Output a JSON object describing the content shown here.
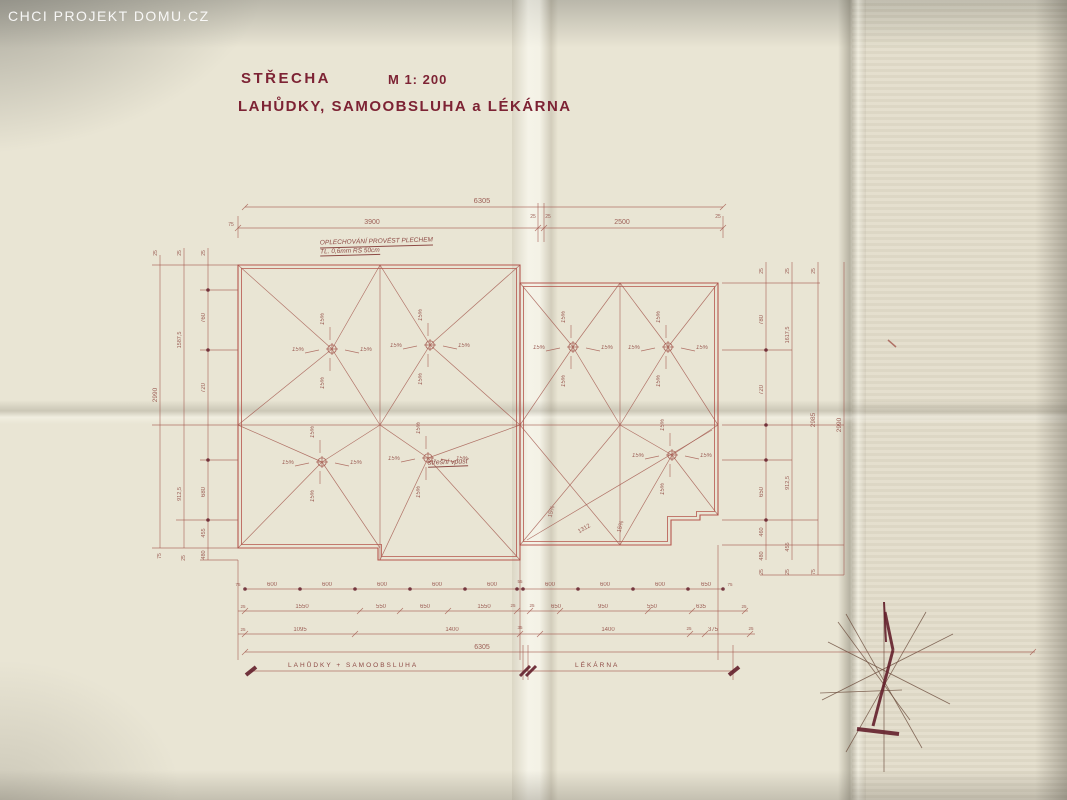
{
  "watermark": "CHCI PROJEKT DOMU.CZ",
  "title": {
    "name": "STŘECHA",
    "scale": "M  1: 200",
    "subtitle": "LAHŮDKY, SAMOOBSLUHA  a  LÉKÁRNA"
  },
  "annotations": {
    "flashing_line1": "OPLECHOVÁNÍ PROVÉST PLECHEM",
    "flashing_line2": "TL. 0,6mm  RŠ 50cm",
    "drain_note": "střešní vpusť"
  },
  "bracket": {
    "left": "LAHŮDKY   +   SAMOOBSLUHA",
    "right": "LÉKÁRNA"
  },
  "colors": {
    "paper": "#e9e5d4",
    "ink_title": "#7d2334",
    "ink_outline": "#b0473f",
    "ink_thin": "#a3574d",
    "ink_text": "#96544c",
    "ink_dark": "#64202c",
    "pencil": "#6e4f3f",
    "watermark_text": "#ffffff"
  },
  "plan": {
    "slope": {
      "label": "15%",
      "offsets": [
        [
          -34,
          2,
          0
        ],
        [
          34,
          2,
          0
        ],
        [
          -8,
          -30,
          -90
        ],
        [
          -8,
          34,
          -90
        ]
      ]
    },
    "outlines": [
      {
        "d": "M238,265 L520,265 L520,560 L378,560 L378,548 L238,548 Z",
        "w": 1.1
      },
      {
        "d": "M241.5,268.5 L516.5,268.5 L516.5,556.5 L381.5,556.5 L381.5,544.5 L241.5,544.5 Z",
        "w": 0.8
      },
      {
        "d": "M520,283 L718,283 L718,515 L700,515 L700,520 L671,520 L671,545 L520,545 Z",
        "w": 1.1
      },
      {
        "d": "M523.5,286.5 L714.5,286.5 L714.5,511.5 L696.5,511.5 L696.5,516.5 L667.5,516.5 L667.5,541.5 L523.5,541.5 Z",
        "w": 0.8
      }
    ],
    "drains": [
      [
        332,
        349
      ],
      [
        430,
        345
      ],
      [
        322,
        462
      ],
      [
        428,
        458
      ],
      [
        573,
        347
      ],
      [
        668,
        347
      ],
      [
        672,
        455
      ]
    ],
    "dots": [
      [
        245,
        589
      ],
      [
        300,
        589
      ],
      [
        355,
        589
      ],
      [
        410,
        589
      ],
      [
        465,
        589
      ],
      [
        517,
        589
      ],
      [
        523,
        589
      ],
      [
        578,
        589
      ],
      [
        633,
        589
      ],
      [
        688,
        589
      ],
      [
        723,
        589
      ],
      [
        208,
        290
      ],
      [
        208,
        350
      ],
      [
        208,
        460
      ],
      [
        208,
        520
      ],
      [
        766,
        350
      ],
      [
        766,
        425
      ],
      [
        766,
        460
      ],
      [
        766,
        520
      ]
    ],
    "lines": [
      [
        380,
        265,
        380,
        560
      ],
      [
        620,
        283,
        620,
        545
      ],
      [
        238,
        425,
        718,
        425
      ],
      [
        238,
        265,
        332,
        349
      ],
      [
        380,
        265,
        332,
        349
      ],
      [
        238,
        425,
        332,
        349
      ],
      [
        380,
        425,
        332,
        349
      ],
      [
        380,
        265,
        430,
        345
      ],
      [
        520,
        265,
        430,
        345
      ],
      [
        380,
        425,
        430,
        345
      ],
      [
        520,
        425,
        430,
        345
      ],
      [
        238,
        425,
        322,
        462
      ],
      [
        380,
        425,
        322,
        462
      ],
      [
        238,
        548,
        322,
        462
      ],
      [
        380,
        548,
        322,
        462
      ],
      [
        380,
        425,
        428,
        458
      ],
      [
        520,
        425,
        428,
        458
      ],
      [
        380,
        560,
        428,
        458
      ],
      [
        520,
        560,
        428,
        458
      ],
      [
        520,
        283,
        573,
        347
      ],
      [
        620,
        283,
        573,
        347
      ],
      [
        520,
        425,
        573,
        347
      ],
      [
        620,
        425,
        573,
        347
      ],
      [
        620,
        283,
        668,
        347
      ],
      [
        718,
        283,
        668,
        347
      ],
      [
        620,
        425,
        668,
        347
      ],
      [
        718,
        425,
        668,
        347
      ],
      [
        620,
        425,
        672,
        455
      ],
      [
        718,
        425,
        672,
        455
      ],
      [
        620,
        545,
        672,
        455
      ],
      [
        718,
        515,
        672,
        455
      ],
      [
        520,
        425,
        620,
        545
      ],
      [
        620,
        425,
        520,
        545
      ],
      [
        527,
        540,
        712,
        430
      ],
      [
        245,
        207,
        723,
        207
      ],
      [
        238,
        228,
        723,
        228
      ],
      [
        238,
        216,
        238,
        238
      ],
      [
        538,
        203,
        538,
        242
      ],
      [
        544,
        203,
        544,
        242
      ],
      [
        723,
        216,
        723,
        238
      ],
      [
        242,
        210,
        248,
        204
      ],
      [
        720,
        210,
        726,
        204
      ],
      [
        235,
        231,
        241,
        225
      ],
      [
        720,
        231,
        726,
        225
      ],
      [
        535,
        231,
        541,
        225
      ],
      [
        541,
        231,
        547,
        225
      ],
      [
        160,
        255,
        160,
        548
      ],
      [
        184,
        248,
        184,
        548
      ],
      [
        208,
        248,
        208,
        560
      ],
      [
        152,
        265,
        238,
        265
      ],
      [
        200,
        290,
        238,
        290
      ],
      [
        200,
        350,
        238,
        350
      ],
      [
        152,
        425,
        238,
        425
      ],
      [
        200,
        460,
        238,
        460
      ],
      [
        176,
        520,
        238,
        520
      ],
      [
        152,
        548,
        238,
        548
      ],
      [
        200,
        560,
        238,
        560
      ],
      [
        766,
        262,
        766,
        560
      ],
      [
        792,
        262,
        792,
        560
      ],
      [
        818,
        262,
        818,
        575
      ],
      [
        844,
        262,
        844,
        575
      ],
      [
        722,
        283,
        820,
        283
      ],
      [
        722,
        350,
        792,
        350
      ],
      [
        722,
        425,
        844,
        425
      ],
      [
        722,
        460,
        792,
        460
      ],
      [
        722,
        520,
        818,
        520
      ],
      [
        722,
        545,
        844,
        545
      ],
      [
        760,
        575,
        844,
        575
      ],
      [
        238,
        560,
        238,
        660
      ],
      [
        520,
        560,
        520,
        660
      ],
      [
        718,
        545,
        718,
        660
      ],
      [
        245,
        589,
        723,
        589
      ],
      [
        238,
        611,
        748,
        611
      ],
      [
        238,
        634,
        755,
        634
      ],
      [
        245,
        652,
        1035,
        652
      ],
      [
        250,
        671,
        733,
        671
      ],
      [
        523,
        645,
        523,
        680
      ],
      [
        528,
        645,
        528,
        680
      ],
      [
        733,
        645,
        733,
        680
      ],
      [
        242,
        614,
        248,
        608
      ],
      [
        357,
        614,
        363,
        608
      ],
      [
        397,
        614,
        403,
        608
      ],
      [
        445,
        614,
        451,
        608
      ],
      [
        514,
        614,
        520,
        608
      ],
      [
        527,
        614,
        533,
        608
      ],
      [
        557,
        614,
        563,
        608
      ],
      [
        645,
        614,
        651,
        608
      ],
      [
        689,
        614,
        695,
        608
      ],
      [
        742,
        614,
        748,
        608
      ],
      [
        242,
        637,
        248,
        631
      ],
      [
        352,
        637,
        358,
        631
      ],
      [
        517,
        637,
        523,
        631
      ],
      [
        537,
        637,
        543,
        631
      ],
      [
        687,
        637,
        693,
        631
      ],
      [
        702,
        637,
        708,
        631
      ],
      [
        747,
        637,
        753,
        631
      ],
      [
        242,
        655,
        248,
        649
      ],
      [
        1030,
        655,
        1036,
        649
      ],
      [
        828,
        642,
        950,
        704,
        0.8,
        1
      ],
      [
        822,
        700,
        953,
        634,
        0.8,
        1
      ],
      [
        846,
        614,
        922,
        748,
        0.8,
        1
      ],
      [
        926,
        612,
        846,
        752,
        0.8,
        1
      ],
      [
        820,
        693,
        902,
        690,
        0.8,
        1
      ],
      [
        884,
        602,
        884,
        772,
        0.8,
        1
      ],
      [
        838,
        622,
        910,
        720,
        0.8,
        1
      ],
      [
        888,
        340,
        896,
        347,
        1.5
      ]
    ],
    "thick": [
      [
        885,
        612,
        893,
        650,
        3
      ],
      [
        893,
        650,
        873,
        726,
        3
      ],
      [
        857,
        729,
        899,
        734,
        4
      ],
      [
        884,
        602,
        886,
        642,
        2
      ],
      [
        246,
        675,
        256,
        667,
        4
      ],
      [
        729,
        675,
        739,
        667,
        4
      ],
      [
        520,
        676,
        530,
        666,
        3
      ],
      [
        526,
        676,
        536,
        666,
        3
      ]
    ],
    "labels": [
      {
        "t": "6305",
        "x": 482,
        "y": 203,
        "s": 7.5
      },
      {
        "t": "3900",
        "x": 372,
        "y": 224,
        "s": 7
      },
      {
        "t": "2500",
        "x": 622,
        "y": 224,
        "s": 7
      },
      {
        "t": "75",
        "x": 231,
        "y": 226,
        "s": 5
      },
      {
        "t": "25",
        "x": 533,
        "y": 218,
        "s": 5
      },
      {
        "t": "25",
        "x": 548,
        "y": 218,
        "s": 5
      },
      {
        "t": "25",
        "x": 718,
        "y": 218,
        "s": 5
      },
      {
        "t": "25",
        "x": 157,
        "y": 253,
        "r": -90,
        "s": 5
      },
      {
        "t": "25",
        "x": 181,
        "y": 253,
        "r": -90,
        "s": 5
      },
      {
        "t": "25",
        "x": 205,
        "y": 253,
        "r": -90,
        "s": 5
      },
      {
        "t": "760",
        "x": 205,
        "y": 318,
        "r": -90,
        "s": 6
      },
      {
        "t": "720",
        "x": 205,
        "y": 388,
        "r": -90,
        "s": 6
      },
      {
        "t": "1587,5",
        "x": 181,
        "y": 340,
        "r": -90,
        "s": 5.5
      },
      {
        "t": "2990",
        "x": 157,
        "y": 395,
        "r": -90,
        "s": 6.5
      },
      {
        "t": "680",
        "x": 205,
        "y": 492,
        "r": -90,
        "s": 6
      },
      {
        "t": "912,5",
        "x": 181,
        "y": 494,
        "r": -90,
        "s": 5.5
      },
      {
        "t": "455",
        "x": 205,
        "y": 533,
        "r": -90,
        "s": 5.5
      },
      {
        "t": "480",
        "x": 205,
        "y": 555,
        "r": -90,
        "s": 5.5
      },
      {
        "t": "75",
        "x": 161,
        "y": 556,
        "r": -90,
        "s": 5
      },
      {
        "t": "25",
        "x": 185,
        "y": 558,
        "r": -90,
        "s": 5
      },
      {
        "t": "25",
        "x": 763,
        "y": 271,
        "r": -90,
        "s": 5
      },
      {
        "t": "25",
        "x": 789,
        "y": 271,
        "r": -90,
        "s": 5
      },
      {
        "t": "25",
        "x": 815,
        "y": 271,
        "r": -90,
        "s": 5
      },
      {
        "t": "780",
        "x": 763,
        "y": 320,
        "r": -90,
        "s": 6
      },
      {
        "t": "1617,5",
        "x": 789,
        "y": 335,
        "r": -90,
        "s": 5.5
      },
      {
        "t": "720",
        "x": 763,
        "y": 390,
        "r": -90,
        "s": 6
      },
      {
        "t": "2985",
        "x": 815,
        "y": 420,
        "r": -90,
        "s": 6.5
      },
      {
        "t": "2990",
        "x": 841,
        "y": 425,
        "r": -90,
        "s": 6.5
      },
      {
        "t": "650",
        "x": 763,
        "y": 492,
        "r": -90,
        "s": 6
      },
      {
        "t": "912,5",
        "x": 789,
        "y": 483,
        "r": -90,
        "s": 5.5
      },
      {
        "t": "460",
        "x": 763,
        "y": 532,
        "r": -90,
        "s": 5.5
      },
      {
        "t": "480",
        "x": 763,
        "y": 556,
        "r": -90,
        "s": 5.5
      },
      {
        "t": "455",
        "x": 789,
        "y": 547,
        "r": -90,
        "s": 5.5
      },
      {
        "t": "25",
        "x": 763,
        "y": 572,
        "r": -90,
        "s": 5
      },
      {
        "t": "25",
        "x": 789,
        "y": 572,
        "r": -90,
        "s": 5
      },
      {
        "t": "75",
        "x": 815,
        "y": 572,
        "r": -90,
        "s": 5
      },
      {
        "t": "75",
        "x": 238,
        "y": 586,
        "s": 4.5
      },
      {
        "t": "600",
        "x": 272,
        "y": 586
      },
      {
        "t": "600",
        "x": 327,
        "y": 586
      },
      {
        "t": "600",
        "x": 382,
        "y": 586
      },
      {
        "t": "600",
        "x": 437,
        "y": 586
      },
      {
        "t": "600",
        "x": 492,
        "y": 586
      },
      {
        "t": "55",
        "x": 520,
        "y": 583,
        "s": 4.5
      },
      {
        "t": "600",
        "x": 550,
        "y": 586
      },
      {
        "t": "600",
        "x": 605,
        "y": 586
      },
      {
        "t": "600",
        "x": 660,
        "y": 586
      },
      {
        "t": "650",
        "x": 706,
        "y": 586
      },
      {
        "t": "75",
        "x": 730,
        "y": 586,
        "s": 4.5
      },
      {
        "t": "25",
        "x": 243,
        "y": 608,
        "s": 4.5
      },
      {
        "t": "1550",
        "x": 302,
        "y": 608
      },
      {
        "t": "550",
        "x": 381,
        "y": 608
      },
      {
        "t": "650",
        "x": 425,
        "y": 608
      },
      {
        "t": "1550",
        "x": 484,
        "y": 608
      },
      {
        "t": "25",
        "x": 513,
        "y": 607,
        "s": 4.5
      },
      {
        "t": "25",
        "x": 532,
        "y": 607,
        "s": 4.5
      },
      {
        "t": "650",
        "x": 556,
        "y": 608
      },
      {
        "t": "950",
        "x": 603,
        "y": 608
      },
      {
        "t": "550",
        "x": 652,
        "y": 608
      },
      {
        "t": "635",
        "x": 701,
        "y": 608
      },
      {
        "t": "25",
        "x": 744,
        "y": 608,
        "s": 4.5
      },
      {
        "t": "25",
        "x": 243,
        "y": 631,
        "s": 4.5
      },
      {
        "t": "1095",
        "x": 300,
        "y": 631
      },
      {
        "t": "1400",
        "x": 452,
        "y": 631
      },
      {
        "t": "35",
        "x": 520,
        "y": 629,
        "s": 4.5
      },
      {
        "t": "1400",
        "x": 608,
        "y": 631
      },
      {
        "t": "25",
        "x": 689,
        "y": 630,
        "s": 4.5
      },
      {
        "t": "375",
        "x": 713,
        "y": 631
      },
      {
        "t": "25",
        "x": 751,
        "y": 630,
        "s": 4.5
      },
      {
        "t": "6305",
        "x": 482,
        "y": 649,
        "s": 7
      },
      {
        "t": "15%",
        "x": 553,
        "y": 512,
        "r": -75,
        "s": 6
      },
      {
        "t": "15%",
        "x": 622,
        "y": 527,
        "r": -75,
        "s": 6
      },
      {
        "t": "1312",
        "x": 585,
        "y": 530,
        "r": -30,
        "s": 6
      }
    ]
  }
}
